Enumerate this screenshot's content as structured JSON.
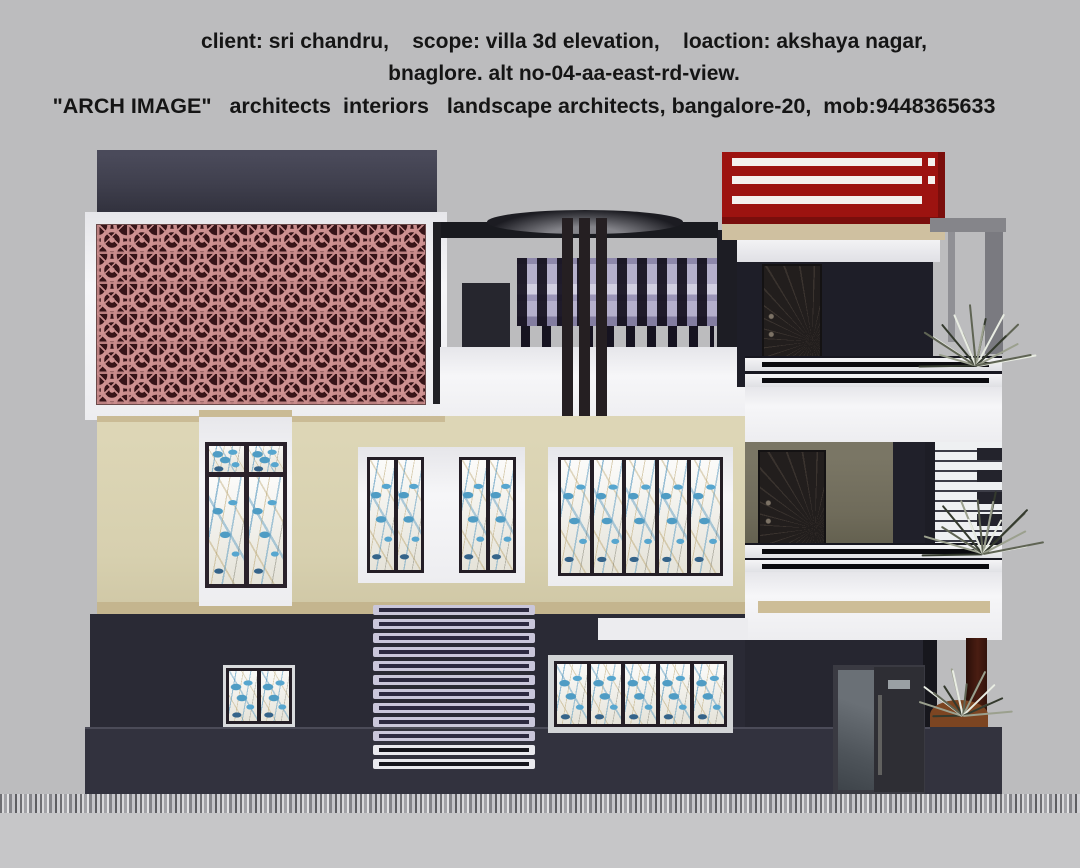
{
  "header": {
    "line1": "client: sri chandru,    scope: villa 3d elevation,    loaction: akshaya nagar,",
    "line2": "bnaglore. alt no-04-aa-east-rd-view.",
    "line3": "\"ARCH IMAGE\"   architects  interiors   landscape architects, bangalore-20,  mob:9448365633"
  },
  "palette": {
    "background": "#bcbcbe",
    "navy_parapet": "#40404e",
    "navy_wall_dark": "#1e1e28",
    "navy_ground": "#2a2a35",
    "compound_wall": "#32323e",
    "cream_wall": "#d7d0af",
    "tan_band": "#c8b995",
    "white_trim": "#f2f2f4",
    "jali_pink": "#c98c8c",
    "jali_ground": "#371418",
    "red_railing": "#9d1310",
    "red_dark": "#7a0e0c",
    "olive_wall": "#6f6b5a",
    "lavender_glass": "#b5b0cc",
    "glass_blue": "#4f9cc4",
    "door_brown": "#221e1d",
    "pillar_brown": "#3d1810",
    "planter_rust": "#7c4522",
    "frame_gray": "#85858a"
  },
  "scene": {
    "description": "3D front elevation render of a two-storey villa: pink jali screen panel upper-left, red terrace railing upper-right, rooftop pergola with purple glass balustrade, cream first-floor wall with blue art-glass windows, dark navy ground floor, white balcony parapets with black-stripe railings, plants on right balconies, gray paved ground strip.",
    "lattice": {
      "cols": 11,
      "rows": 6
    },
    "louver": {
      "slats": 12,
      "light_slats": 10
    },
    "windows": {
      "left_tall_panes": 2,
      "mid_window_groups": 2,
      "mid_window_panes_per_group": 2,
      "wide_window_panes": 5,
      "bottom_window_panes": 5,
      "small_window_panes": 2
    },
    "plants": [
      {
        "x": 975,
        "y": 366,
        "size": 62,
        "blades": 16,
        "seed": 1
      },
      {
        "x": 982,
        "y": 554,
        "size": 64,
        "blades": 16,
        "seed": 2
      },
      {
        "x": 962,
        "y": 716,
        "size": 50,
        "blades": 14,
        "seed": 3
      }
    ]
  }
}
